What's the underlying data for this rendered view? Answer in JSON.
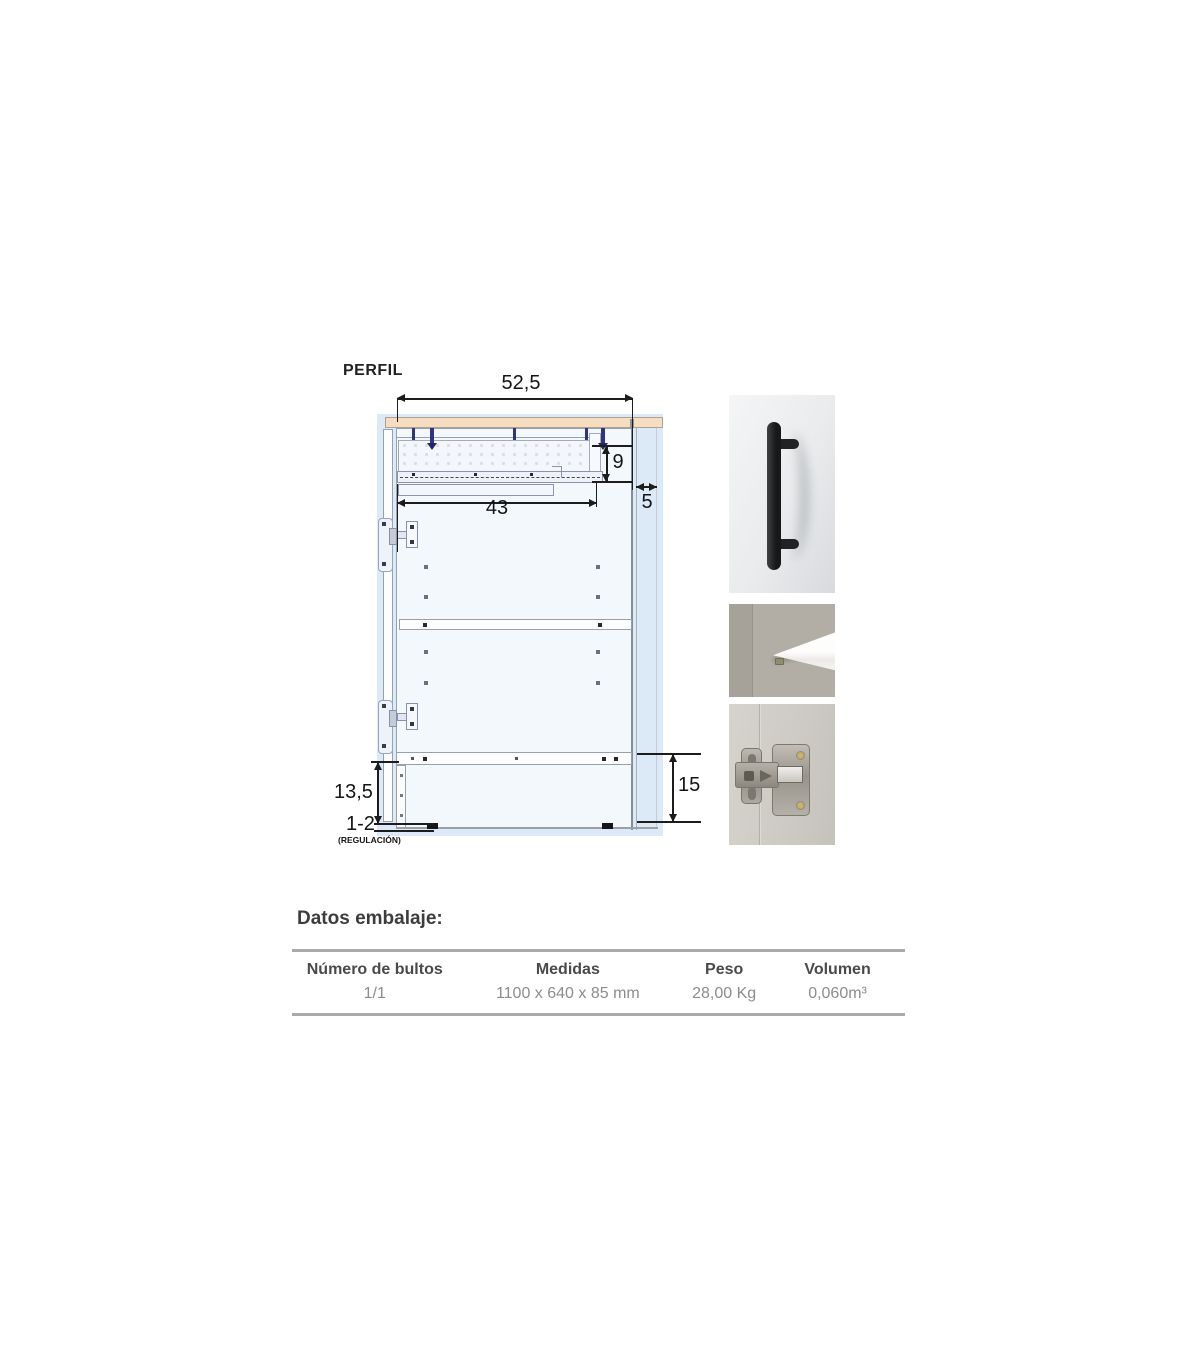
{
  "colors": {
    "blueprint_bg": "#dce9f6",
    "countertop_tan": "#f6ddc0",
    "line_gray": "#9aa0a8",
    "screw_navy": "#2f3383",
    "dim_black": "#1c1c1c",
    "text_dark": "#3d3d3d",
    "text_gray": "#8c8c8c",
    "table_border": "#a8aaac"
  },
  "diagram": {
    "label": "PERFIL",
    "dims": {
      "total_width": "52,5",
      "drawer_height": "9",
      "back_gap": "5",
      "runner_length": "43",
      "plinth_height": "13,5",
      "leg_adjust": "1-2",
      "leg_adjust_note": "(REGULACIÓN)",
      "plinth_total": "15"
    }
  },
  "photos": [
    {
      "name": "black-bar-handle-photo"
    },
    {
      "name": "shelf-pin-photo"
    },
    {
      "name": "concealed-hinge-photo"
    }
  ],
  "packaging": {
    "heading": "Datos embalaje:",
    "table": {
      "headers": [
        "Número de bultos",
        "Medidas",
        "Peso",
        "Volumen"
      ],
      "row": [
        "1/1",
        "1100 x 640 x 85 mm",
        "28,00 Kg",
        "0,060m³"
      ]
    }
  }
}
